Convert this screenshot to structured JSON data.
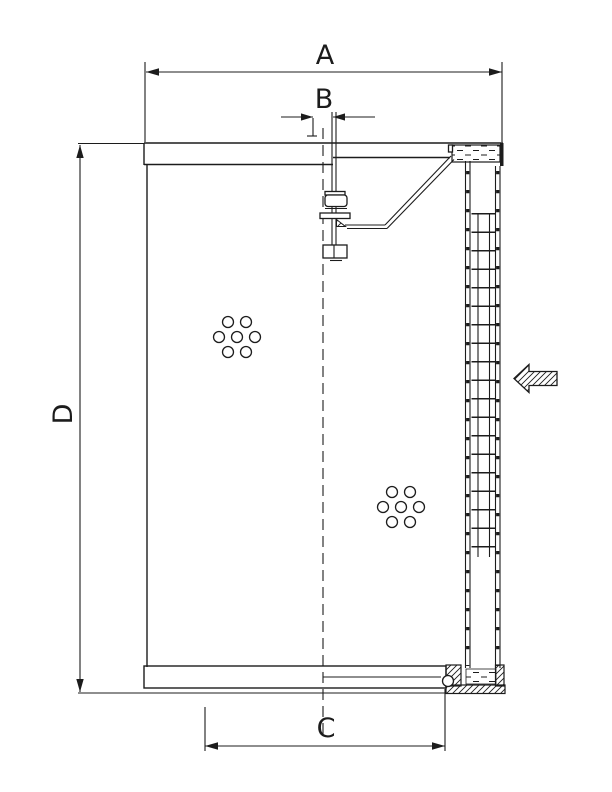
{
  "drawing": {
    "background": "#ffffff",
    "line_color": "#1c1c1c",
    "hatch_color": "#1c1c1c"
  },
  "dimensions": {
    "a": "A",
    "b": "B",
    "c": "C",
    "d": "D"
  },
  "icons": {
    "flow_arrow": "inlet-flow-arrow-left"
  }
}
